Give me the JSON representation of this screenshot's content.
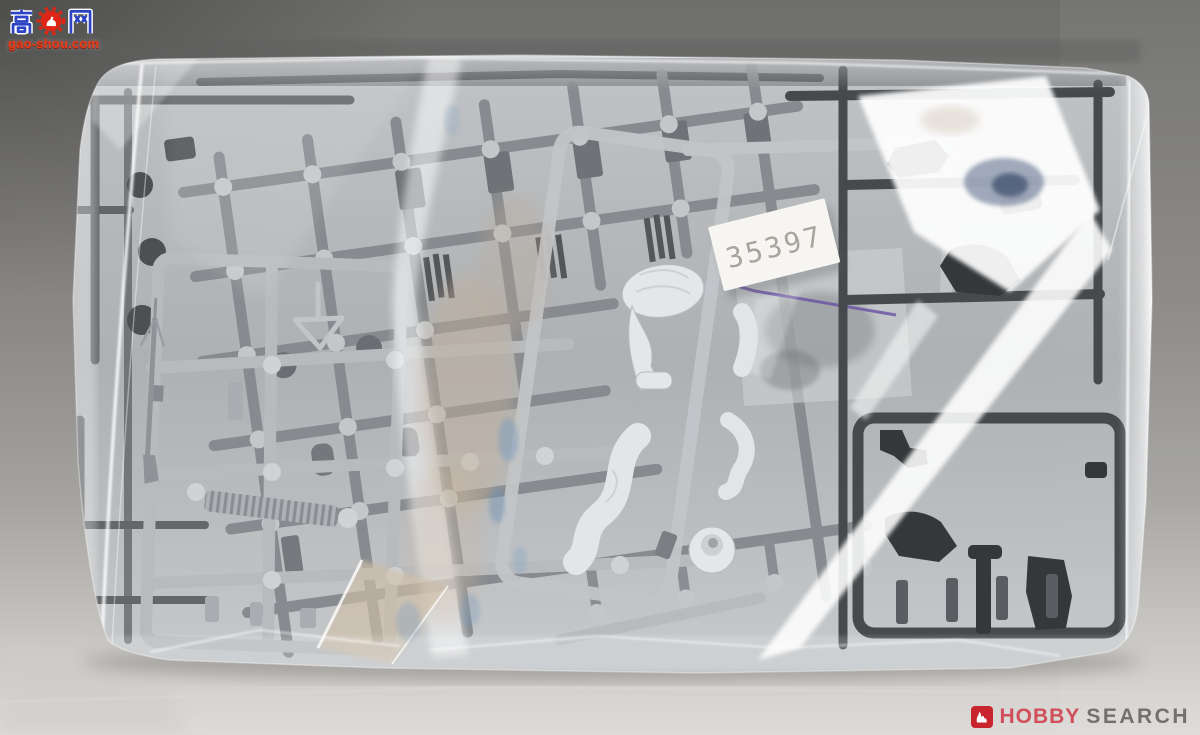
{
  "watermark": {
    "text_cn": "高手网",
    "site": "gao-shou.com",
    "icon": "gear-thumb-icon",
    "text_color": "#2b43c4",
    "site_color": "#e8401c"
  },
  "price_label": {
    "number": "35397",
    "background": "#f6f5f1",
    "digit_color": "#a7a49d"
  },
  "branding": {
    "word1": "HOBBY",
    "word2": "SEARCH",
    "word1_color": "#d04f5b",
    "word2_color": "#73716f",
    "icon": "flame-icon",
    "icon_bg": "#c9252f"
  },
  "scene": {
    "bag": "clear plastic bag with model kit sprues",
    "pouch_seal_color": "#6e56a4",
    "sprue_colors": {
      "light": "#b8bbbe",
      "medium": "#86898d",
      "dark": "#474a4d",
      "white_parts": "#e4e7e9"
    },
    "background_top": "#6e6e6c",
    "background_bottom": "#dedcd9"
  }
}
